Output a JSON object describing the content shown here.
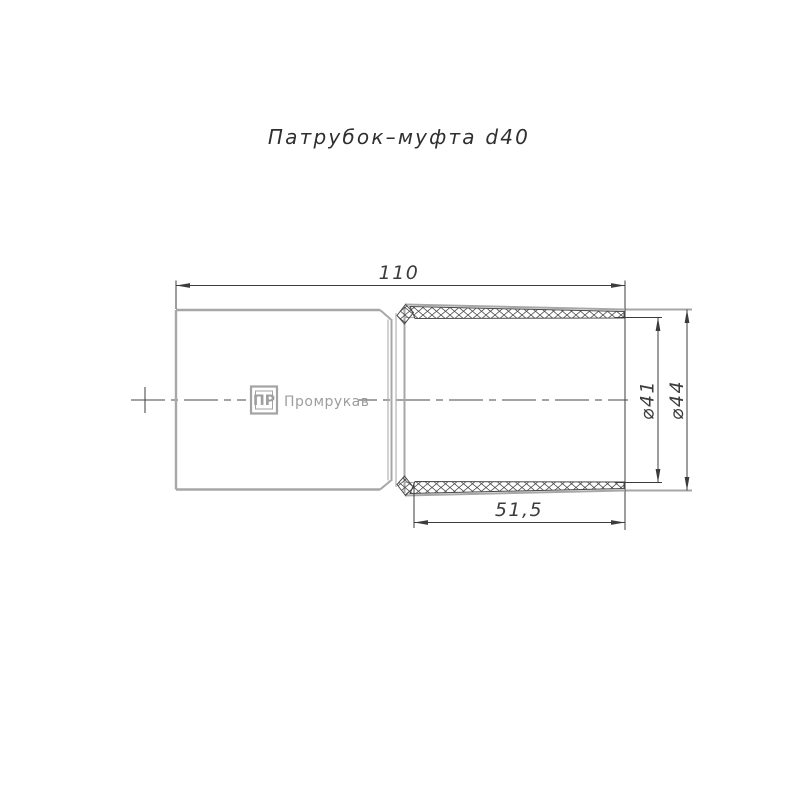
{
  "title": "Патрубок–муфта d40",
  "dimensions": {
    "length_total": "110",
    "socket_depth": "51,5",
    "diameter_inner": "⌀41",
    "diameter_outer": "⌀44"
  },
  "logo": {
    "monogram": "ПР",
    "brand": "Промрукав"
  },
  "colors": {
    "background": "#ffffff",
    "body_outline_gray": "#a7a7a7",
    "dimension_dark": "#3c3c3c",
    "hatch_dark": "#4a4a4a",
    "logo_gray": "#9e9e9e",
    "title_color": "#2f2f2f"
  }
}
